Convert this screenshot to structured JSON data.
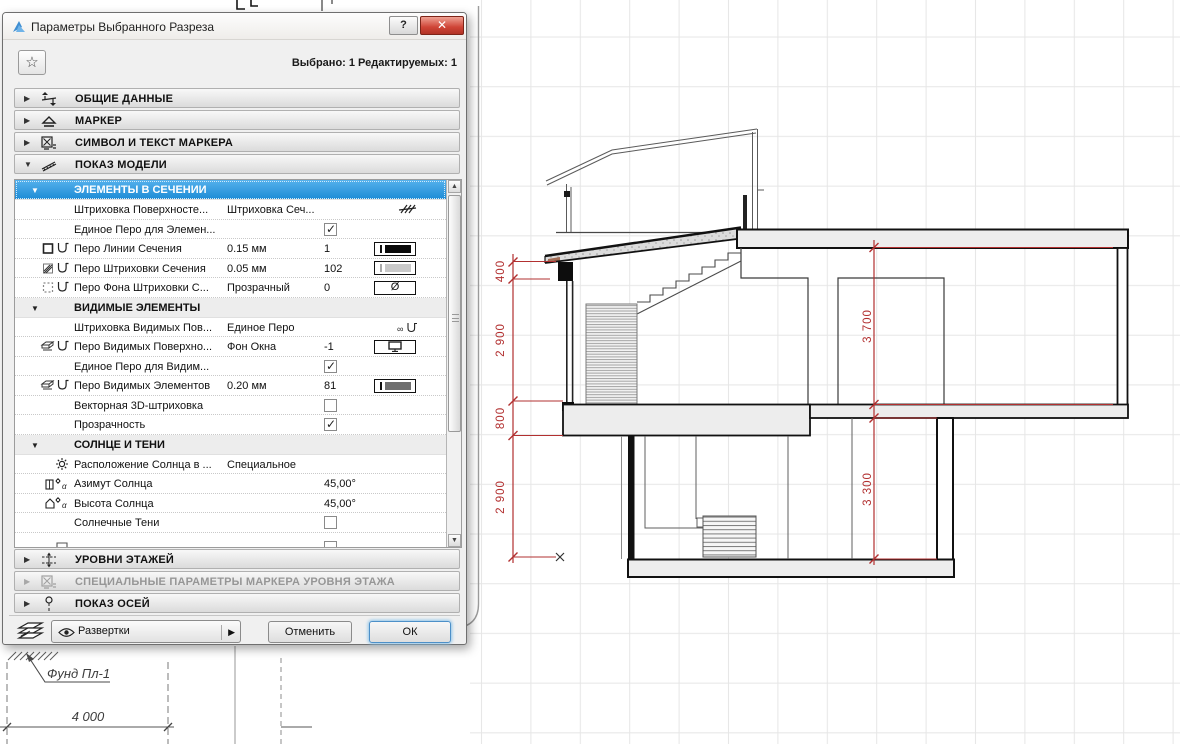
{
  "window": {
    "title": "Параметры Выбранного Разреза",
    "help_label": "?",
    "selection_info": "Выбрано: 1 Редактируемых: 1"
  },
  "sections": {
    "general": "ОБЩИЕ ДАННЫЕ",
    "marker": "МАРКЕР",
    "symbol_text": "СИМВОЛ И ТЕКСТ МАРКЕРА",
    "model_display": "ПОКАЗ МОДЕЛИ",
    "story_levels": "УРОВНИ ЭТАЖЕЙ",
    "special_marker": "СПЕЦИАЛЬНЫЕ ПАРАМЕТРЫ МАРКЕРА УРОВНЯ ЭТАЖА",
    "axes": "ПОКАЗ ОСЕЙ"
  },
  "model_display": {
    "groups": [
      {
        "title": "ЭЛЕМЕНТЫ В СЕЧЕНИИ",
        "rows": [
          {
            "label": "Штриховка Поверхносте...",
            "value": "Штриховка Сеч..."
          },
          {
            "label": "Единое Перо для Элемен...",
            "checked": true
          },
          {
            "label": "Перо Линии Сечения",
            "value": "0.15 мм",
            "pen": "1"
          },
          {
            "label": "Перо Штриховки Сечения",
            "value": "0.05 мм",
            "pen": "102"
          },
          {
            "label": "Перо Фона Штриховки С...",
            "value": "Прозрачный",
            "pen": "0"
          }
        ]
      },
      {
        "title": "ВИДИМЫЕ ЭЛЕМЕНТЫ",
        "rows": [
          {
            "label": "Штриховка Видимых Пов...",
            "value": "Единое Перо"
          },
          {
            "label": "Перо Видимых Поверхно...",
            "value": "Фон Окна",
            "pen": "-1"
          },
          {
            "label": "Единое Перо для Видим...",
            "checked": true
          },
          {
            "label": "Перо Видимых Элементов",
            "value": "0.20 мм",
            "pen": "81"
          },
          {
            "label": "Векторная 3D-штриховка",
            "checked": false
          },
          {
            "label": "Прозрачность",
            "checked": true
          }
        ]
      },
      {
        "title": "СОЛНЦЕ И ТЕНИ",
        "rows": [
          {
            "label": "Расположение Солнца в ...",
            "value": "Специальное"
          },
          {
            "label": "Азимут Солнца",
            "pen": "45,00°"
          },
          {
            "label": "Высота Солнца",
            "pen": "45,00°"
          },
          {
            "label": "Солнечные Тени",
            "checked": false
          }
        ]
      }
    ]
  },
  "footer": {
    "flyout_label": "Развертки",
    "cancel_label": "Отменить",
    "ok_label": "ОК"
  },
  "drawing": {
    "dims_left": [
      "400",
      "2 900",
      "800",
      "2 900"
    ],
    "dims_right": [
      "3 700",
      "3 300"
    ],
    "foundation_label": "Фунд Пл-1",
    "bottom_dim": "4 000"
  },
  "colors": {
    "selection_blue": "#2d9be2",
    "dimension_red": "#b23030",
    "close_red": "#cf4436",
    "grid_gray": "#e6e6e6"
  },
  "icons": [
    "archicad-logo-icon",
    "help-icon",
    "close-icon",
    "star-icon",
    "expand-arrow-icon",
    "general-data-icon",
    "marker-icon",
    "symbol-text-icon",
    "model-display-icon",
    "story-levels-icon",
    "special-marker-icon",
    "axes-icon",
    "line-pen-icon",
    "fill-pen-icon",
    "background-pen-icon",
    "surface-pen-icon",
    "sun-icon",
    "sun-azimuth-icon",
    "sun-altitude-icon",
    "hatch-icon",
    "uniform-pen-icon",
    "monitor-icon",
    "null-pen-icon",
    "layers-stack-icon",
    "eye-icon",
    "flyout-arrow-icon",
    "scroll-up-icon",
    "scroll-down-icon",
    "zero-level-icon"
  ]
}
